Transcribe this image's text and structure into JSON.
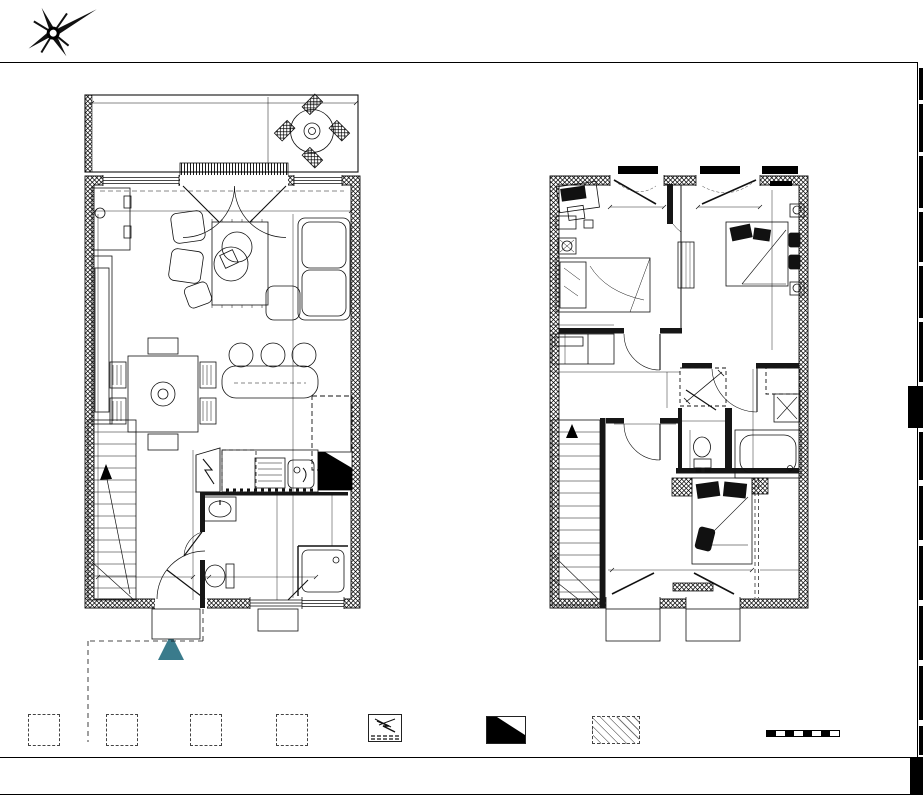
{
  "compass": {
    "n": "N",
    "e": "E",
    "s": "S",
    "o": "O"
  },
  "colors": {
    "room_label": "#4a7282",
    "entry_marker": "#3a7b8c"
  },
  "ground": {
    "terrasse": "TERRASSE",
    "sejour": "SÉJOUR - CUISINE",
    "entree": "ENTRÉE",
    "sde": "SDE",
    "pare_vue": "Pare-vue",
    "terrace_level": "-8cm/Niveau Intérieur",
    "entry_level": "-4cm/Niveau Intérieur",
    "d589": "589",
    "d150": "150",
    "d522": "522",
    "d578": "578",
    "d864": "864",
    "d286": "286",
    "d223": "223",
    "d210": "210",
    "d214": "214",
    "d121": "121",
    "d90": "90",
    "fri": "Fri",
    "cu": "Cu",
    "lv": "LV",
    "lt": "LT",
    "pe": "PE",
    "fav": "F-AV",
    "pf": "PF",
    "pg": "PG",
    "r": "R"
  },
  "upper": {
    "chambre3": "CHAMBRE 3 + PL",
    "chambre2": "CHAMBRE 2",
    "palier": "PALIER",
    "wc": "WC",
    "bains": "BAINS",
    "chambre1": "CHAMBRE 1 + PL",
    "pl": "PL",
    "fav": "F-AV",
    "ll": "LL",
    "r": "R",
    "d244": "244",
    "d273": "273",
    "d378": "378",
    "d120": "120",
    "d65": "65",
    "d352": "352",
    "d95": "95",
    "d139": "139",
    "d100": "100",
    "d125": "125",
    "d225": "225",
    "d171": "171",
    "d356": "356"
  },
  "stairs": {
    "steps": [
      "15",
      "14",
      "13",
      "12",
      "11",
      "10",
      "09",
      "08",
      "07",
      "06",
      "05",
      "04",
      "03",
      "02",
      "01"
    ]
  },
  "legend": {
    "items": [
      {
        "tag": "Cu",
        "label": "Emplacement Cuisson"
      },
      {
        "tag": "Fri",
        "label": "Emplacement Réfrigérateur"
      },
      {
        "tag": "LL",
        "label": "Emplacement Lave-Linge"
      },
      {
        "tag": "LV",
        "label": "Emplacement Lave-Vaisselle"
      },
      {
        "label": "Espace technique électrique du logement"
      },
      {
        "label": "Gaine technique"
      },
      {
        "label": "Faux-plafond Soffite"
      }
    ]
  },
  "scale": {
    "t0": "0",
    "t1": "1",
    "t2": "2m",
    "label": "Echelle"
  },
  "note": "Nota : Le présent plan est établi sur la base du dossier de permis de construire et pourra subir des adaptations dimensionnelles, techniques et d'organisation afin de répondre aux contraintes induites par les études d'exécution. Les poutres, poteaux, soffites, canalisations et faux plafonds n'apparaissent pas systématiquement sur le présent plan. Les surfaces ainsi que l'emplacement des équipements et le mobilier sont mentionnés à titre indicatif. Les plantations éventuelles ne sont pas contractuelles. L'implantation des meubles évier et autres éléments de cuisine de l'opération est indicative, et permet de visualiser le positionnement des arrivées et évacuations d'eau à la livraison du logement."
}
